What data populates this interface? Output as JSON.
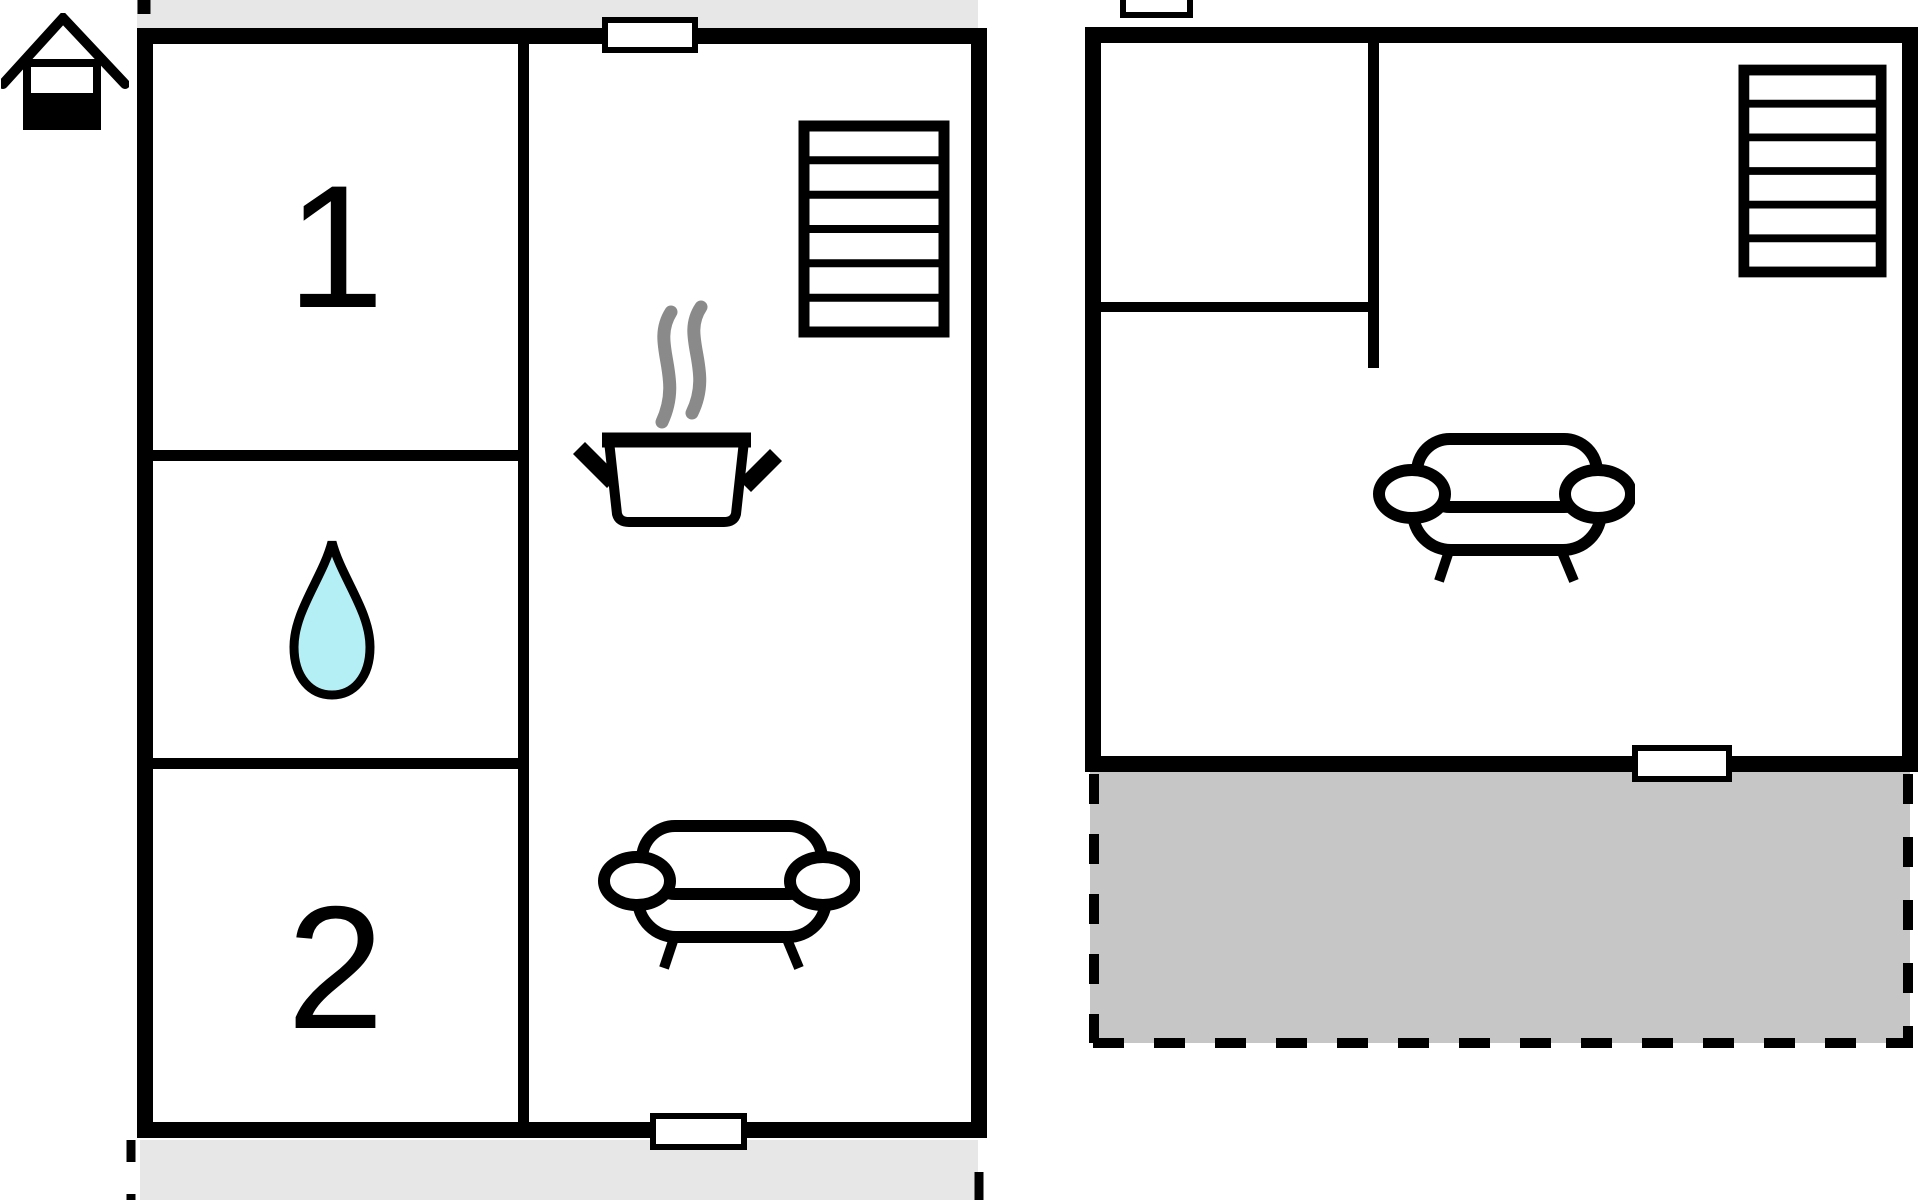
{
  "floorplan": {
    "title_present": false,
    "left_unit": {
      "room1_label": "1",
      "room2_label": "2",
      "features": [
        "bedroom-1",
        "bathroom-with-water-drop",
        "bedroom-2",
        "kitchen-living-area"
      ],
      "stairs_steps": 6,
      "openings": [
        "top-window",
        "bottom-window"
      ]
    },
    "right_unit": {
      "features": [
        "small-room-top-left",
        "living-area-with-sofa",
        "terrace"
      ],
      "stairs_steps": 6,
      "openings": [
        "bottom-door",
        "chimney-box-top"
      ]
    },
    "icons": [
      "house-icon",
      "water-drop-icon",
      "stove-pot-icon",
      "steam-icon",
      "stairs-icon",
      "sofa-icon"
    ],
    "colors": {
      "wall": "#000000",
      "water_drop_fill": "#b3eff5",
      "steam_gray": "#8a8a8a",
      "strip_gray": "#e7e7e7",
      "terrace_gray": "#c6c6c6",
      "background": "#ffffff"
    }
  }
}
